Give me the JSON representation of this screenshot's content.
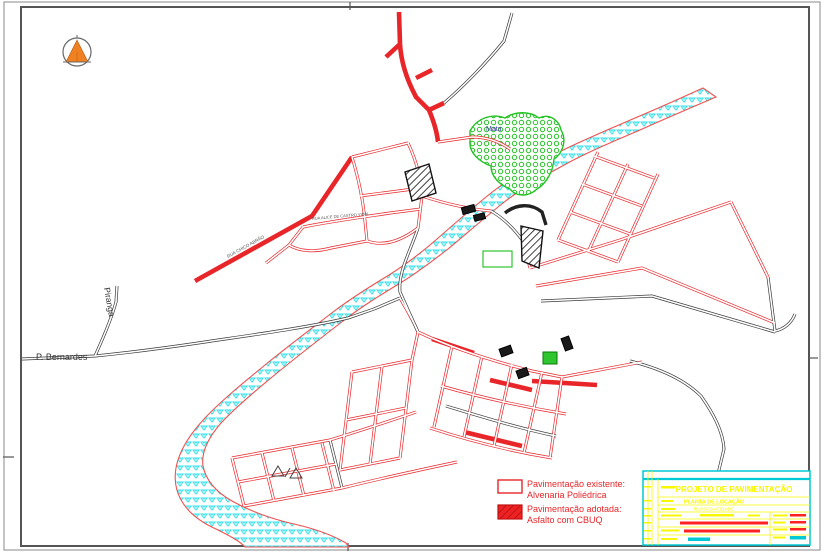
{
  "drawing": {
    "type": "cad-pavement-plan",
    "north_arrow": {
      "fill": "#f08122",
      "ring": "#666666"
    },
    "labels": {
      "piranga": "Piranga",
      "p_bernardes": "P. Bernardes",
      "mata": "Mata"
    },
    "street_labels": [
      {
        "text": "RUA ALICE DE CASTRO VIDAL",
        "x": 312,
        "y": 220,
        "rot": -5,
        "size": 4
      },
      {
        "text": "RUA CHICO ABRÃO",
        "x": 228,
        "y": 258,
        "rot": -29,
        "size": 4.5
      }
    ],
    "colors": {
      "road_red": "#e8262a",
      "road_black": "#3a3a3a",
      "river_stroke": "#f05050",
      "river_hatch": "#2ee0ea",
      "mata_green": "#24c324",
      "mata_label": "#3f3f9f",
      "rural_text": "#333333"
    }
  },
  "legend": {
    "text_color": "#e8262a",
    "items": [
      {
        "swatch": "outline",
        "title": "Pavimentação existente:",
        "subtitle": "Alvenaria Poliédrica"
      },
      {
        "swatch": "filled",
        "title": "Pavimentação adotada:",
        "subtitle": "Asfalto com CBUQ"
      }
    ]
  },
  "title_block": {
    "colors": {
      "border": "#00c8d4",
      "text": "#f7f700",
      "accent": "#ff2222",
      "value": "#00c8d4"
    },
    "title": "PROJETO DE PAVIMENTAÇÃO",
    "subtitle": "PLANTA DE LOCAÇÃO",
    "line3": "RUAS DA CIDADE",
    "lines": {
      "h": [
        497,
        505,
        512,
        519,
        527,
        535
      ],
      "v_main": 658,
      "v_right": 770,
      "strip": [
        648,
        652
      ]
    },
    "bars": [
      {
        "x": 661,
        "y": 486,
        "w": 14,
        "h": 2.5,
        "c": "y"
      },
      {
        "x": 661,
        "y": 500,
        "w": 12,
        "h": 2,
        "c": "y"
      },
      {
        "x": 661,
        "y": 508,
        "w": 14,
        "h": 2,
        "c": "y"
      },
      {
        "x": 661,
        "y": 514.5,
        "w": 20,
        "h": 2,
        "c": "y"
      },
      {
        "x": 700,
        "y": 514,
        "w": 34,
        "h": 2.5,
        "c": "y"
      },
      {
        "x": 748,
        "y": 514.5,
        "w": 12,
        "h": 2,
        "c": "y"
      },
      {
        "x": 680,
        "y": 521.5,
        "w": 88,
        "h": 3,
        "c": "r"
      },
      {
        "x": 661,
        "y": 529.5,
        "w": 18,
        "h": 2,
        "c": "y"
      },
      {
        "x": 684,
        "y": 529.5,
        "w": 76,
        "h": 3,
        "c": "r"
      },
      {
        "x": 661,
        "y": 538,
        "w": 16,
        "h": 2,
        "c": "y"
      },
      {
        "x": 688,
        "y": 537.5,
        "w": 22,
        "h": 3.5,
        "c": "c"
      },
      {
        "x": 773,
        "y": 514.5,
        "w": 14,
        "h": 2,
        "c": "y"
      },
      {
        "x": 790,
        "y": 514,
        "w": 16,
        "h": 2.5,
        "c": "r"
      },
      {
        "x": 773,
        "y": 521.5,
        "w": 12,
        "h": 2,
        "c": "y"
      },
      {
        "x": 790,
        "y": 521,
        "w": 16,
        "h": 2.5,
        "c": "r"
      },
      {
        "x": 773,
        "y": 528.5,
        "w": 14,
        "h": 2,
        "c": "y"
      },
      {
        "x": 790,
        "y": 528,
        "w": 16,
        "h": 2.5,
        "c": "r"
      },
      {
        "x": 773,
        "y": 536.5,
        "w": 12,
        "h": 2,
        "c": "y"
      },
      {
        "x": 790,
        "y": 536,
        "w": 16,
        "h": 3.5,
        "c": "c"
      },
      {
        "x": 644,
        "y": 486,
        "w": 7,
        "h": 1.5,
        "c": "y"
      },
      {
        "x": 644,
        "y": 500,
        "w": 7,
        "h": 1.5,
        "c": "y"
      },
      {
        "x": 644,
        "y": 508,
        "w": 7,
        "h": 1.5,
        "c": "y"
      },
      {
        "x": 644,
        "y": 515,
        "w": 7,
        "h": 1.5,
        "c": "y"
      },
      {
        "x": 644,
        "y": 522,
        "w": 7,
        "h": 1.5,
        "c": "y"
      },
      {
        "x": 644,
        "y": 530,
        "w": 7,
        "h": 1.5,
        "c": "y"
      },
      {
        "x": 644,
        "y": 538,
        "w": 7,
        "h": 1.5,
        "c": "y"
      }
    ]
  },
  "map": {
    "frame_ticks": [
      {
        "x1": 350,
        "y1": 2,
        "x2": 350,
        "y2": 10
      },
      {
        "x1": 348,
        "y1": 543,
        "x2": 348,
        "y2": 551
      },
      {
        "x1": 3,
        "y1": 457,
        "x2": 14,
        "y2": 457
      },
      {
        "x1": 810,
        "y1": 358,
        "x2": 818,
        "y2": 358
      }
    ],
    "river_path": "M716 97 C688 109 662 120 640 130 C612 142 588 152 566 164 C544 176 522 188 503 203 C483 219 465 235 448 249 C430 263 414 275 397 285 C379 296 361 307 343 321 C321 338 299 355 277 373 C255 391 235 408 221 423 C208 438 201 452 203 466 C206 481 216 492 232 501 C250 511 272 519 294 524 C316 529 334 536 346 543 L349 547 L245 547 C240 541 228 535 216 529 C198 521 186 510 180 498 C174 486 174 472 178 460 C182 447 191 433 205 418 C221 401 243 383 265 365 C287 347 311 329 333 312 C353 297 371 286 389 275 C405 265 421 253 437 239 C453 225 471 209 491 193 C511 177 533 166 557 153 C581 141 607 130 635 118 C659 108 681 98 703 88 L716 97 Z",
    "mata_path": "M470 131 C477 118 492 113 505 118 C515 111 530 111 539 118 C549 113 559 120 561 130 C567 140 563 153 554 159 C553 171 547 183 537 189 C529 197 516 197 510 189 C500 185 491 177 491 166 C480 162 469 153 470 142 Z",
    "roads": [
      {
        "t": "k",
        "d": "M22 359 L95 356 C135 352 165 348 205 342 C245 336 305 328 348 318 L374 309"
      },
      {
        "t": "k",
        "d": "M95 356 C103 338 111 320 116 302 L117 286"
      },
      {
        "t": "k",
        "d": "M374 309 L400 298"
      },
      {
        "t": "r",
        "d": "M400 298 C408 312 414 322 418 332"
      },
      {
        "t": "R",
        "d": "M399 12 L400 44 C401 62 407 80 416 97 L429 110"
      },
      {
        "t": "R",
        "d": "M400 44 L386 57"
      },
      {
        "t": "R",
        "d": "M416 78 L432 70"
      },
      {
        "t": "k",
        "d": "M444 103 C464 86 487 62 504 41 L512 13"
      },
      {
        "t": "R",
        "d": "M429 110 L444 103"
      },
      {
        "t": "R",
        "d": "M429 110 C434 122 437 132 438 142"
      },
      {
        "t": "r",
        "d": "M438 142 L472 137 C488 137 500 142 510 149"
      },
      {
        "t": "R",
        "d": "M195 281 L312 216 L352 157"
      },
      {
        "t": "r",
        "d": "M352 157 L408 143"
      },
      {
        "t": "r",
        "d": "M408 143 C416 160 421 178 422 196 L418 228"
      },
      {
        "t": "r",
        "d": "M352 157 C359 180 363 200 365 221 L367 241"
      },
      {
        "t": "r",
        "d": "M367 241 C384 247 401 241 418 228"
      },
      {
        "t": "r",
        "d": "M360 196 L421 188"
      },
      {
        "t": "r",
        "d": "M303 227 C333 221 363 217 390 213 L421 209"
      },
      {
        "t": "r",
        "d": "M303 227 L289 245 C300 252 316 252 331 248 L367 241"
      },
      {
        "t": "r",
        "d": "M289 245 L266 263"
      },
      {
        "t": "k",
        "d": "M418 228 C410 252 398 272 400 292 L418 332"
      },
      {
        "t": "r",
        "d": "M422 196 C446 204 469 209 491 211"
      },
      {
        "t": "k",
        "d": "M491 211 C505 219 515 230 523 241"
      },
      {
        "t": "kT",
        "d": "M505 213 C516 204 531 203 542 212 L546 225"
      },
      {
        "t": "r",
        "d": "M523 241 L530 268"
      },
      {
        "t": "r",
        "d": "M530 268 L620 240 L731 202"
      },
      {
        "t": "r",
        "d": "M536 286 L642 268 L775 323"
      },
      {
        "t": "k",
        "d": "M541 301 L652 296 L775 332"
      },
      {
        "t": "k",
        "d": "M768 277 L775 331 C785 329 792 322 795 314"
      },
      {
        "t": "r",
        "d": "M731 202 L768 277"
      },
      {
        "t": "r",
        "d": "M558 240 L598 152"
      },
      {
        "t": "r",
        "d": "M588 252 L628 164"
      },
      {
        "t": "r",
        "d": "M618 262 L658 174"
      },
      {
        "t": "r",
        "d": "M558 240 L618 262"
      },
      {
        "t": "r",
        "d": "M570 212 L630 234"
      },
      {
        "t": "r",
        "d": "M582 184 L642 206"
      },
      {
        "t": "r",
        "d": "M594 156 L654 178"
      },
      {
        "t": "r",
        "d": "M418 332 C452 348 492 361 532 371 L562 377"
      },
      {
        "t": "R",
        "d": "M432 339 L474 353"
      },
      {
        "t": "r",
        "d": "M452 346 L434 427"
      },
      {
        "t": "r",
        "d": "M482 356 L464 437"
      },
      {
        "t": "r",
        "d": "M512 364 L494 446"
      },
      {
        "t": "r",
        "d": "M542 372 L524 453"
      },
      {
        "t": "r",
        "d": "M562 377 L550 458"
      },
      {
        "t": "r",
        "d": "M430 428 C470 441 510 451 552 458"
      },
      {
        "t": "r",
        "d": "M441 386 C483 398 524 407 566 414"
      },
      {
        "t": "k",
        "d": "M446 406 C486 418 518 428 556 436"
      },
      {
        "t": "R",
        "d": "M490 380 L532 390"
      },
      {
        "t": "R",
        "d": "M464 432 L522 446"
      },
      {
        "t": "R",
        "d": "M532 381 L597 385"
      },
      {
        "t": "r",
        "d": "M562 377 L642 362"
      },
      {
        "t": "k",
        "d": "M630 361 C662 369 686 381 701 396 C713 413 723 431 724 449 L717 478"
      },
      {
        "t": "r",
        "d": "M232 458 L330 440"
      },
      {
        "t": "r",
        "d": "M238 482 L336 464"
      },
      {
        "t": "r",
        "d": "M244 506 L342 488"
      },
      {
        "t": "r",
        "d": "M232 458 L244 506"
      },
      {
        "t": "r",
        "d": "M262 453 L274 501"
      },
      {
        "t": "r",
        "d": "M292 448 L304 496"
      },
      {
        "t": "r",
        "d": "M322 443 L334 491"
      },
      {
        "t": "k",
        "d": "M330 440 L342 488"
      },
      {
        "t": "r",
        "d": "M330 440 C362 430 390 421 416 412"
      },
      {
        "t": "r",
        "d": "M342 488 C382 478 420 470 457 462"
      },
      {
        "t": "r",
        "d": "M352 372 L340 470"
      },
      {
        "t": "r",
        "d": "M382 366 L370 464"
      },
      {
        "t": "r",
        "d": "M412 360 L400 458"
      },
      {
        "t": "r",
        "d": "M340 470 L400 458"
      },
      {
        "t": "r",
        "d": "M346 420 L406 408"
      },
      {
        "t": "r",
        "d": "M352 372 L412 360"
      },
      {
        "t": "r",
        "d": "M412 360 L418 332"
      }
    ],
    "buildings": [
      {
        "type": "hatch",
        "pts": "405,172 429,164 436,193 412,201"
      },
      {
        "type": "hatch",
        "pts": "521,226 543,231 539,268 522,261"
      },
      {
        "type": "black",
        "x": 462,
        "y": 206,
        "w": 13,
        "h": 7,
        "rot": -15
      },
      {
        "type": "black",
        "x": 474,
        "y": 214,
        "w": 11,
        "h": 6,
        "rot": -15
      },
      {
        "type": "black",
        "x": 500,
        "y": 347,
        "w": 12,
        "h": 8,
        "rot": -20
      },
      {
        "type": "black",
        "x": 563,
        "y": 337,
        "w": 8,
        "h": 13,
        "rot": -20
      },
      {
        "type": "black",
        "x": 517,
        "y": 369,
        "w": 11,
        "h": 8,
        "rot": -20
      },
      {
        "type": "green",
        "x": 543,
        "y": 352,
        "w": 14,
        "h": 12,
        "rot": 0
      },
      {
        "type": "green-outline",
        "x": 483,
        "y": 251,
        "w": 29,
        "h": 16,
        "rot": 0
      }
    ],
    "symbols": [
      {
        "type": "triangle",
        "pts": "272,476 278,466 284,476"
      },
      {
        "type": "slash",
        "x1": 285,
        "y1": 477,
        "x2": 290,
        "y2": 468
      },
      {
        "type": "triangle",
        "pts": "290,478 296,468 302,478"
      }
    ]
  }
}
